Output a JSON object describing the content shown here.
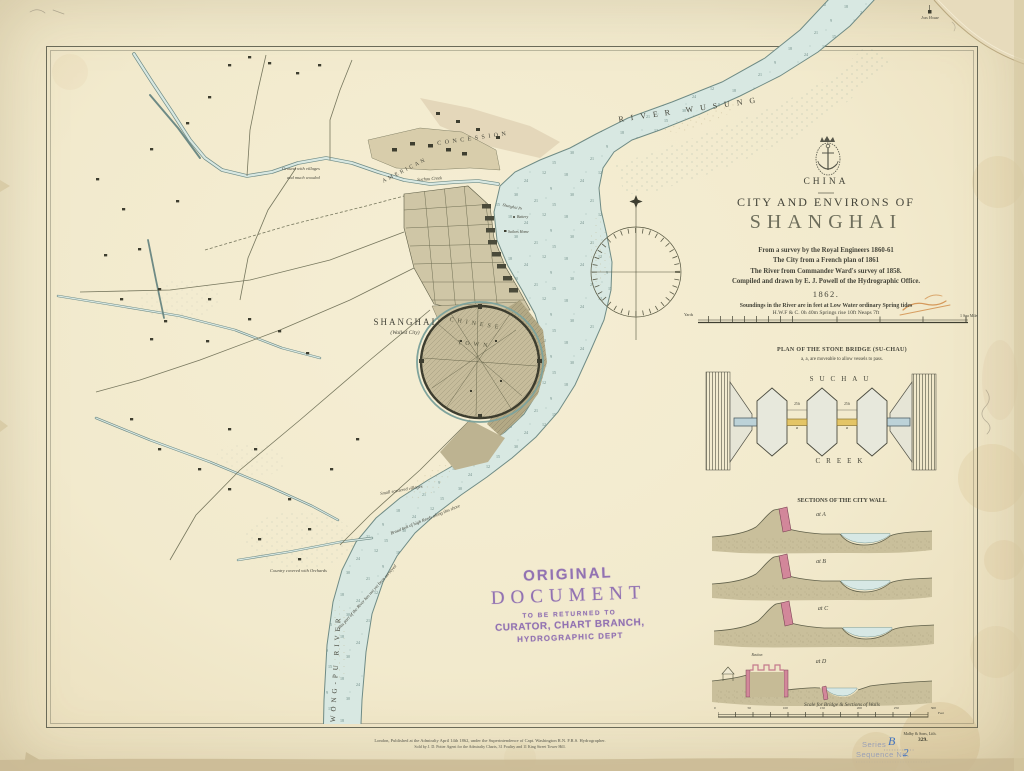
{
  "colors": {
    "paper": "#f2eacd",
    "water": "#d8e8e2",
    "ink": "#45453a",
    "wall_pink": "#d2879a",
    "span_yellow": "#e4c566",
    "stamp_purple": "#7d58ac",
    "handwriting_blue": "#4073c0"
  },
  "title_block": {
    "country": "CHINA",
    "subtitle": "CITY AND ENVIRONS OF",
    "title": "SHANGHAI",
    "source_lines": [
      "From a survey by the Royal Engineers 1860-61",
      "The City from a French plan of 1861",
      "The River from Commander Ward's survey of 1858.",
      "Compiled and drawn by E. J. Powell of the Hydrographic Office."
    ],
    "year": "1862.",
    "soundings_note": "Soundings in the River are in feet at Low Water ordinary Spring tides",
    "tide_note": "H.W.F & C. 0h 40m Springs rise 10ft Neaps 7ft",
    "scale_label_yards": "Yards",
    "scale_label_mile": "1 Sea Mile"
  },
  "map_labels": {
    "river_wusung": "RIVER WUSUNG",
    "wong_pu_river": "WONG-PU RIVER",
    "shanghai": "SHANGHAI",
    "walled_city": "(Walled City)",
    "chinese": "CHINESE",
    "town": "TOWN",
    "american": "AMERICAN",
    "concession": "CONCESSION",
    "suchau_creek": "Suchau Creek",
    "ground_note_line1": "Ground with villages",
    "ground_note_line2": "and much wooded",
    "villages_note": "Small scattered villages",
    "reeds_note": "Broad belt of high Reeds along this shore",
    "unsurveyed_note": "This part of the River has not yet been surveyed",
    "orchards_note": "Country covered with Orchards",
    "joss_house": "Joss House",
    "shanghai_point": "Shanghai Pt",
    "battery": "Battery",
    "sailors_home": "Sailors Home"
  },
  "bridge_plan": {
    "title": "PLAN OF THE STONE BRIDGE (SU-CHAU)",
    "note": "a, a, are moveable to allow vessels to pass.",
    "water_label_top": "SUCHAU",
    "water_label_bottom": "CREEK",
    "span_label": "a",
    "span_dimension": "25ft"
  },
  "wall_sections": {
    "title": "SECTIONS OF THE CITY WALL",
    "section_labels": [
      "at A",
      "at B",
      "at C",
      "at D"
    ],
    "bastion_label": "Bastion",
    "scale_caption": "Scale for Bridge & Sections of Walls",
    "scale_ticks": [
      "0",
      "50",
      "100",
      "150",
      "200",
      "250",
      "300"
    ],
    "scale_unit": "Feet"
  },
  "stamp": {
    "line1": "ORIGINAL",
    "line2": "DOCUMENT",
    "line3": "TO BE RETURNED TO",
    "line4": "CURATOR, CHART BRANCH,",
    "line5": "HYDROGRAPHIC DEPT"
  },
  "footer": {
    "imprint_line1": "London, Published at the Admiralty April 14th 1862, under the Superintendence of Capt. Washington R.N. F.R.S. Hydrographer.",
    "imprint_line2": "Sold by J. D. Potter Agent for the Admiralty Charts, 31 Poultry and 11 King Street Tower Hill.",
    "lithographer": "Malby & Sons, Lith.",
    "chart_number": "329.",
    "series_label": "Series",
    "series_value": "B",
    "sequence_label": "Sequence No.",
    "sequence_value": "2"
  }
}
